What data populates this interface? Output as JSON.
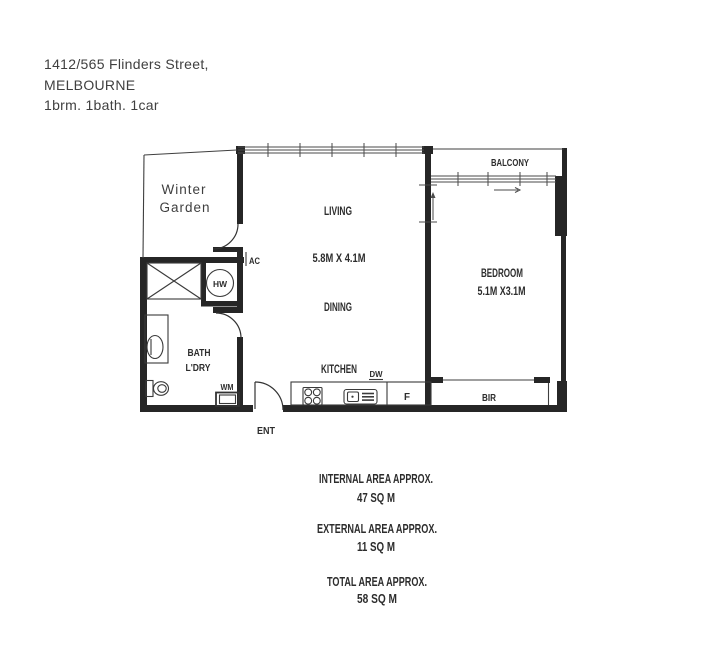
{
  "header": {
    "address_line1": "1412/565 Flinders Street,",
    "address_line2": "MELBOURNE",
    "summary": "1brm. 1bath. 1car"
  },
  "plan": {
    "winter_garden_line1": "Winter",
    "winter_garden_line2": "Garden",
    "living": "LIVING",
    "living_dims": "5.8M X 4.1M",
    "dining": "DINING",
    "kitchen": "KITCHEN",
    "bedroom": "BEDROOM",
    "bedroom_dims": "5.1M X3.1M",
    "balcony": "BALCONY",
    "bath_line1": "BATH",
    "bath_line2": "L'DRY",
    "bir": "BIR",
    "ent": "ENT",
    "ac": "AC",
    "hw": "HW",
    "wm": "WM",
    "dw": "DW",
    "fridge": "F"
  },
  "areas": {
    "internal_label": "INTERNAL AREA APPROX.",
    "internal_value": "47 SQ M",
    "external_label": "EXTERNAL AREA APPROX.",
    "external_value": "11 SQ M",
    "total_label": "TOTAL AREA APPROX.",
    "total_value": "58 SQ M"
  },
  "colors": {
    "wall": "#262626",
    "line": "#444444",
    "text": "#2d2d2d",
    "header_text": "#3f3f3f"
  }
}
